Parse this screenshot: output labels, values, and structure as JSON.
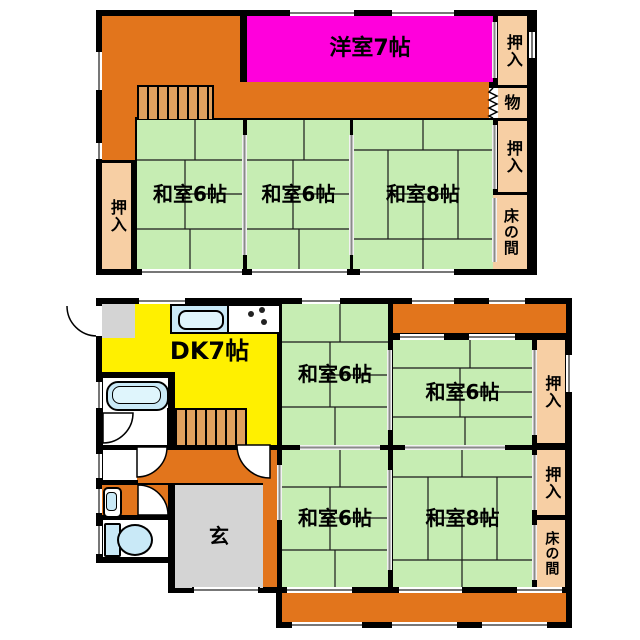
{
  "title": "2-story Japanese house floor plan",
  "colors": {
    "orange": "#E2751C",
    "tan": "#DFA05E",
    "green": "#C6EDB3",
    "peach": "#F7CFA4",
    "magenta": "#FF00DC",
    "yellow": "#FFF000",
    "blue": "#C9E9F7",
    "blue2": "#DFF5FC",
    "gray": "#D4D4D4",
    "wall": "#000000"
  },
  "floor2": {
    "western_room": "洋室7帖",
    "japanese_room_6_left": "和室6帖",
    "japanese_room_6_mid": "和室6帖",
    "japanese_room_8": "和室8帖",
    "closet_right_top": "押入",
    "storage": "物",
    "closet_right_mid": "押入",
    "alcove": "床の間",
    "closet_left": "押入"
  },
  "floor1": {
    "dining_kitchen": "DK7帖",
    "japanese_room_6_nw": "和室6帖",
    "japanese_room_6_ne": "和室6帖",
    "japanese_room_6_sw": "和室6帖",
    "japanese_room_8_se": "和室8帖",
    "closet_top": "押入",
    "closet_mid": "押入",
    "alcove": "床の間",
    "entrance": "玄"
  }
}
